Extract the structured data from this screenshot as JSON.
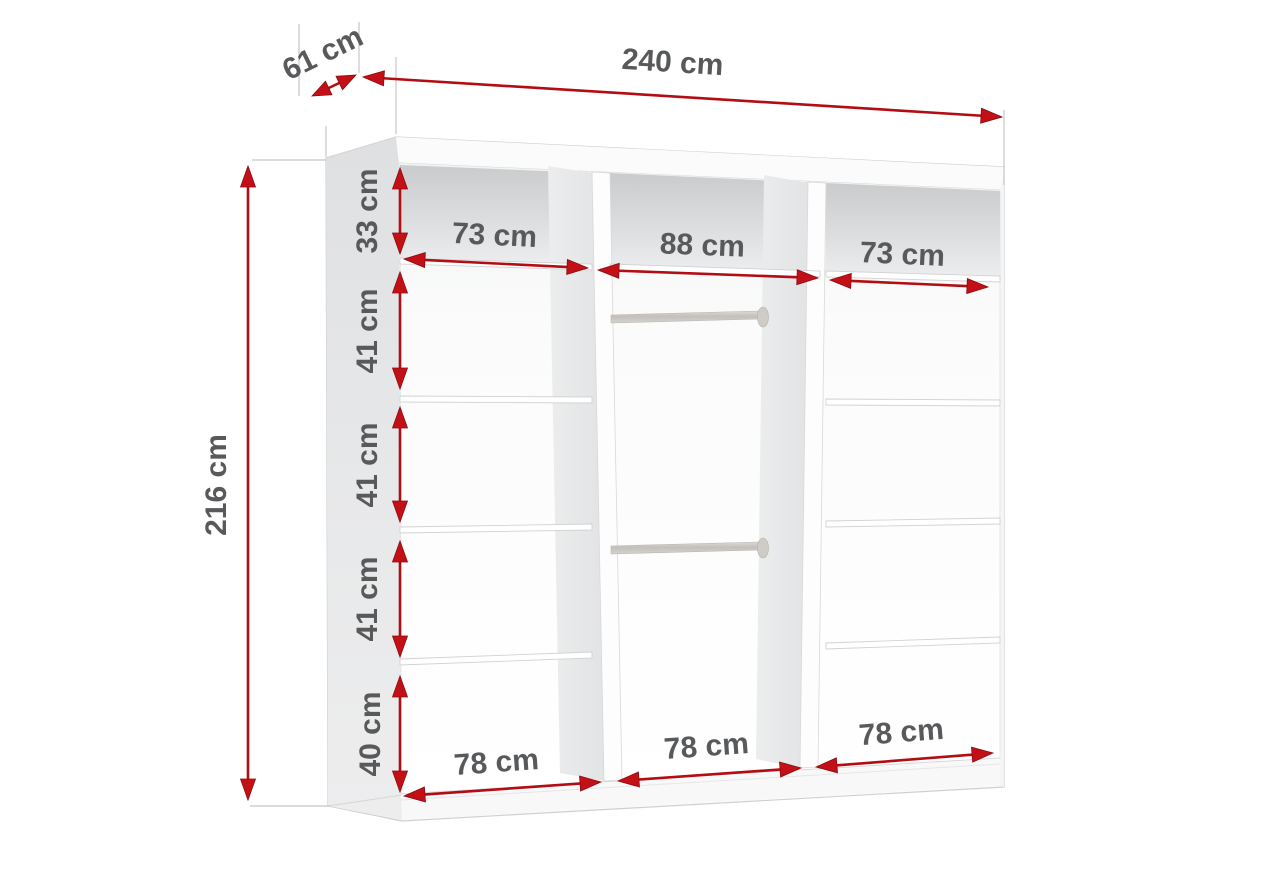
{
  "diagram": {
    "type": "furniture-dimension-diagram",
    "subject": "wardrobe interior with shelves and hanging rails",
    "unit": "cm",
    "colors": {
      "dimension_arrow": "#c31017",
      "dimension_text": "#58595b",
      "cabinet_fill": "#ffffff",
      "side_panel": "#e4e5e7",
      "top_compartment_shade": "#cfd1d2",
      "rail": "#cfccc8"
    },
    "overall": {
      "width": {
        "value": 240,
        "label": "240 cm"
      },
      "depth": {
        "value": 61,
        "label": "61 cm"
      },
      "height": {
        "value": 216,
        "label": "216 cm"
      }
    },
    "shelf_heights": [
      {
        "value": 33,
        "label": "33 cm"
      },
      {
        "value": 41,
        "label": "41 cm"
      },
      {
        "value": 41,
        "label": "41 cm"
      },
      {
        "value": 41,
        "label": "41 cm"
      },
      {
        "value": 40,
        "label": "40 cm"
      }
    ],
    "section_widths_top": [
      {
        "value": 73,
        "label": "73 cm"
      },
      {
        "value": 88,
        "label": "88 cm"
      },
      {
        "value": 73,
        "label": "73 cm"
      }
    ],
    "section_widths_bottom": [
      {
        "value": 78,
        "label": "78 cm"
      },
      {
        "value": 78,
        "label": "78 cm"
      },
      {
        "value": 78,
        "label": "78 cm"
      }
    ],
    "features": {
      "sections": 3,
      "hanging_rails_middle_section": 2
    }
  }
}
